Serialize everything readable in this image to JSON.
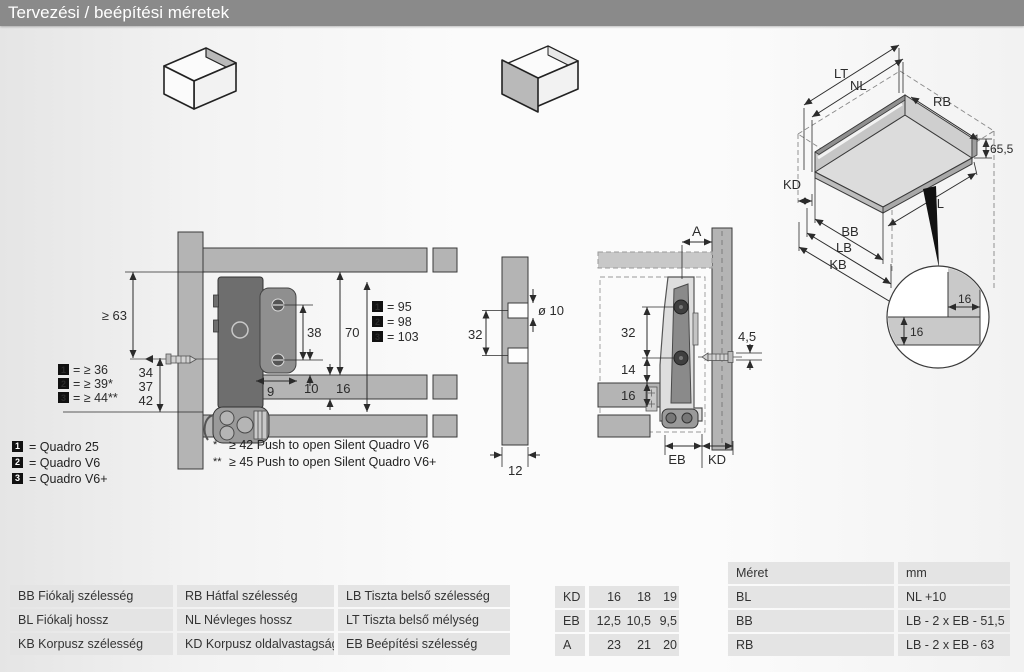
{
  "title": "Tervezési / beépítési méretek",
  "colors": {
    "title_bar_bg": "#8a8a8a",
    "panel_gray": "#b4b4b4",
    "table_row_bg": "#e4e4e4",
    "mech_dark": "#6e6e6e"
  },
  "legend": {
    "items": [
      {
        "num": "1",
        "label": "= Quadro 25"
      },
      {
        "num": "2",
        "label": "= Quadro V6"
      },
      {
        "num": "3",
        "label": "= Quadro V6+"
      }
    ]
  },
  "notes": {
    "items": [
      {
        "mark": "*",
        "text": "≥ 42 Push to open Silent Quadro V6"
      },
      {
        "mark": "**",
        "text": "≥ 45 Push to open Silent Quadro V6+"
      }
    ]
  },
  "left_drawing": {
    "dim_min63": "≥ 63",
    "offsets": {
      "v34": "34",
      "v37": "37",
      "v42": "42"
    },
    "min_rows": [
      {
        "num": "1",
        "text": "= ≥ 36"
      },
      {
        "num": "2",
        "text": "= ≥ 39*"
      },
      {
        "num": "3",
        "text": "= ≥ 44**"
      }
    ],
    "height_rows": [
      {
        "num": "1",
        "text": "= 95"
      },
      {
        "num": "2",
        "text": "= 98"
      },
      {
        "num": "3",
        "text": "= 103"
      }
    ],
    "dim38": "38",
    "dim70": "70",
    "dim9": "9",
    "dim10": "10",
    "dim16": "16"
  },
  "hole_drawing": {
    "dia": "ø 10",
    "dim32": "32",
    "dim12": "12"
  },
  "side_drawing": {
    "dimA": "A",
    "dim32": "32",
    "dim14": "14",
    "dim16": "16",
    "dim45": "4,5",
    "eb": "EB",
    "kd": "KD"
  },
  "iso_drawing": {
    "lt": "LT",
    "nl": "NL",
    "rb": "RB",
    "kd": "KD",
    "bb": "BB",
    "lb": "LB",
    "kb": "KB",
    "bl": "BL",
    "h": "65,5",
    "detail_h": "16",
    "detail_w": "16"
  },
  "def_table": {
    "rows": [
      [
        "BB Fiókalj szélesség",
        "RB Hátfal szélesség",
        "LB Tiszta belső szélesség"
      ],
      [
        "BL Fiókalj hossz",
        "NL Névleges hossz",
        "LT Tiszta belső mélység"
      ],
      [
        "KB Korpusz szélesség",
        "KD Korpusz oldalvastagságok",
        "EB Beépítési szélesség"
      ]
    ]
  },
  "value_table": {
    "rows": [
      {
        "label": "KD",
        "v1": "16",
        "v2": "18",
        "v3": "19"
      },
      {
        "label": "EB",
        "v1": "12,5",
        "v2": "10,5",
        "v3": "9,5"
      },
      {
        "label": "A",
        "v1": "23",
        "v2": "21",
        "v3": "20"
      }
    ]
  },
  "formula_table": {
    "header": {
      "c1": "Méret",
      "c2": "mm"
    },
    "rows": [
      {
        "c1": "BL",
        "c2": "NL +10"
      },
      {
        "c1": "BB",
        "c2": "LB - 2 x EB - 51,5"
      },
      {
        "c1": "RB",
        "c2": "LB - 2 x EB - 63"
      }
    ]
  }
}
